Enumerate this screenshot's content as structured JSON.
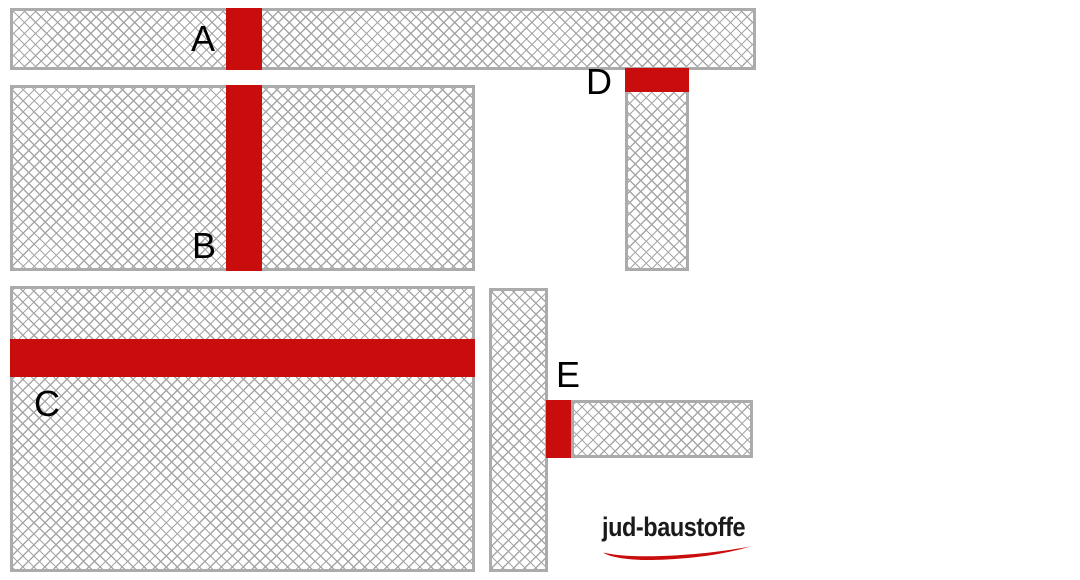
{
  "labels": {
    "a": "A",
    "b": "B",
    "c": "C",
    "d": "D",
    "e": "E"
  },
  "logo": {
    "text": "jud-baustoffe",
    "swoosh_icon": "red-underline-swoosh"
  },
  "colors": {
    "seal_red": "#C90C0C",
    "wall_border": "#ABABAB",
    "hatch_line": "#A7A7A7",
    "label_text": "#000000",
    "logo_text": "#1A1A1A"
  }
}
